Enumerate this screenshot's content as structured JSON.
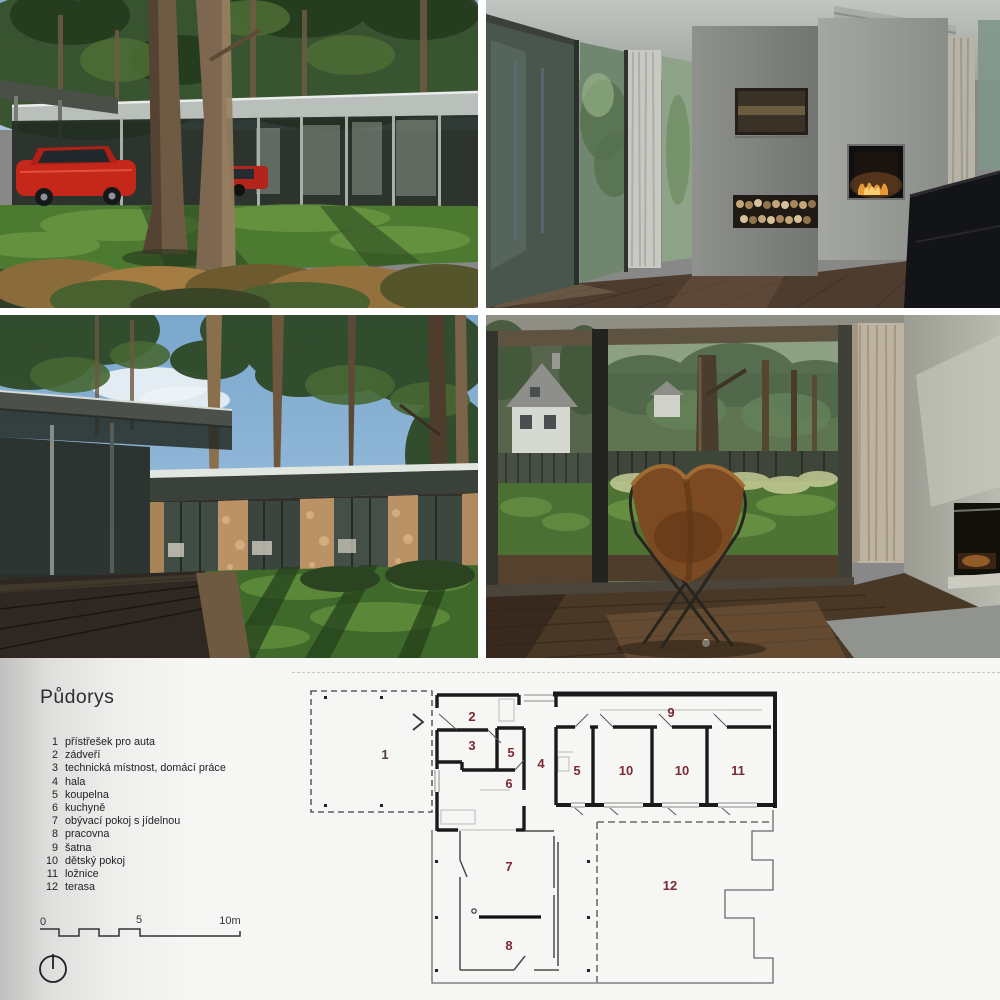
{
  "section": {
    "heading": "Půdorys"
  },
  "legend": {
    "items": [
      {
        "num": "1",
        "label": "přístřešek pro auta"
      },
      {
        "num": "2",
        "label": "zádveří"
      },
      {
        "num": "3",
        "label": "technická místnost, domácí práce"
      },
      {
        "num": "4",
        "label": "hala"
      },
      {
        "num": "5",
        "label": "koupelna"
      },
      {
        "num": "6",
        "label": "kuchyně"
      },
      {
        "num": "7",
        "label": "obývací pokoj s jídelnou"
      },
      {
        "num": "8",
        "label": "pracovna"
      },
      {
        "num": "9",
        "label": "šatna"
      },
      {
        "num": "10",
        "label": "dětský pokoj"
      },
      {
        "num": "11",
        "label": "ložnice"
      },
      {
        "num": "12",
        "label": "terasa"
      }
    ]
  },
  "plan": {
    "room_labels": [
      "1",
      "2",
      "3",
      "5",
      "4",
      "6",
      "9",
      "5",
      "10",
      "10",
      "11",
      "7",
      "8",
      "12"
    ],
    "scale_labels": {
      "zero": "0",
      "five": "5",
      "ten": "10m"
    }
  },
  "colors": {
    "room_number": "#7b2a33",
    "plan_wall": "#1a1a1a",
    "page_background": "#f6f6f4"
  }
}
